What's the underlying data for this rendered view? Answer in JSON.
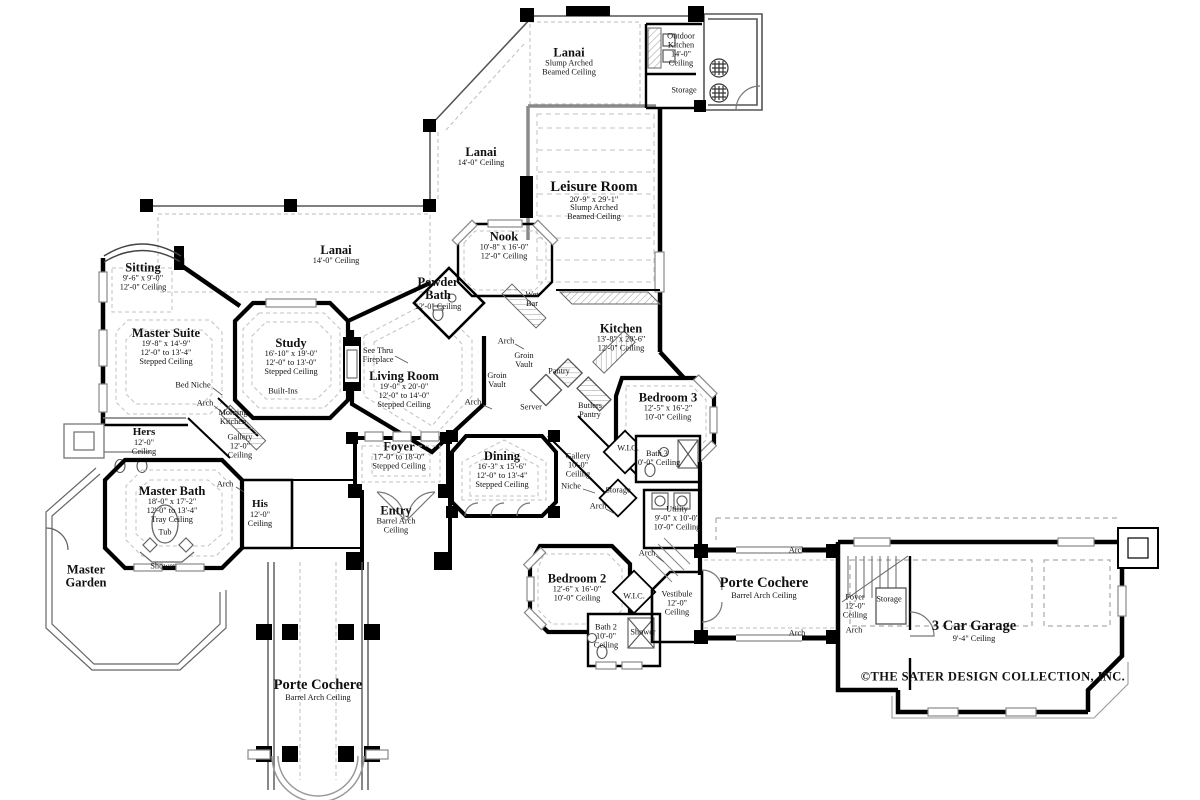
{
  "document": {
    "type": "residential floor plan",
    "copyright": "©THE SATER DESIGN COLLECTION, INC."
  },
  "labels": [
    {
      "id": "lanai-top",
      "x": 569,
      "y": 62,
      "sz": "m",
      "tl": [
        "Lanai"
      ],
      "s": [
        "Slump Arched",
        "Beamed Ceiling"
      ]
    },
    {
      "id": "outdoor-kitchen",
      "x": 681,
      "y": 50,
      "s": [
        "Outdoor",
        "Kitchen",
        "14'-0\"",
        "Ceiling"
      ]
    },
    {
      "id": "storage-outdoor",
      "x": 684,
      "y": 91,
      "s": [
        "Storage"
      ]
    },
    {
      "id": "lanai-upper",
      "x": 481,
      "y": 157,
      "sz": "m",
      "tl": [
        "Lanai"
      ],
      "s": [
        "14'-0\" Ceiling"
      ]
    },
    {
      "id": "leisure-room",
      "x": 594,
      "y": 201,
      "sz": "l",
      "tl": [
        "Leisure Room"
      ],
      "s": [
        "20'-9\" x 29'-1\"",
        "Slump Arched",
        "Beamed Ceiling"
      ]
    },
    {
      "id": "nook",
      "x": 504,
      "y": 246,
      "sz": "m",
      "tl": [
        "Nook"
      ],
      "s": [
        "10'-8\" x 16'-0\"",
        "12'-0\" Ceiling"
      ]
    },
    {
      "id": "lanai-main",
      "x": 336,
      "y": 255,
      "sz": "m",
      "tl": [
        "Lanai"
      ],
      "s": [
        "14'-0\" Ceiling"
      ]
    },
    {
      "id": "sitting",
      "x": 143,
      "y": 277,
      "sz": "m",
      "tl": [
        "Sitting"
      ],
      "s": [
        "9'-6\" x 9'-0\"",
        "12'-0\" Ceiling"
      ]
    },
    {
      "id": "powder-bath",
      "x": 438,
      "y": 294,
      "sz": "m",
      "tl": [
        "Powder",
        "Bath"
      ],
      "s": [
        "12'-0\" Ceiling"
      ]
    },
    {
      "id": "wet-bar",
      "x": 532,
      "y": 300,
      "s": [
        "Wet",
        "Bar"
      ]
    },
    {
      "id": "master-suite",
      "x": 166,
      "y": 347,
      "sz": "m",
      "tl": [
        "Master Suite"
      ],
      "s": [
        "19'-8\" x 14'-9\"",
        "12'-0\" to 13'-4\"",
        "Stepped Ceiling"
      ]
    },
    {
      "id": "study",
      "x": 291,
      "y": 357,
      "sz": "m",
      "tl": [
        "Study"
      ],
      "s": [
        "16'-10\" x 19'-0\"",
        "12'-0\" to 13'-0\"",
        "Stepped Ceiling"
      ]
    },
    {
      "id": "kitchen",
      "x": 621,
      "y": 338,
      "sz": "m",
      "tl": [
        "Kitchen"
      ],
      "s": [
        "13'-8\" x 20'-6\"",
        "12'-0\" Ceiling"
      ]
    },
    {
      "id": "see-thru-fireplace",
      "x": 378,
      "y": 356,
      "s": [
        "See Thru",
        "Fireplace"
      ]
    },
    {
      "id": "arch-wetbar",
      "x": 506,
      "y": 342,
      "s": [
        "Arch"
      ]
    },
    {
      "id": "groin-vault-upper",
      "x": 524,
      "y": 361,
      "s": [
        "Groin",
        "Vault"
      ]
    },
    {
      "id": "pantry",
      "x": 559,
      "y": 372,
      "s": [
        "Pantry"
      ]
    },
    {
      "id": "living-room",
      "x": 404,
      "y": 390,
      "sz": "m",
      "tl": [
        "Living Room"
      ],
      "s": [
        "19'-0\" x 20'-0\"",
        "12'-0\" to 14'-0\"",
        "Stepped Ceiling"
      ]
    },
    {
      "id": "groin-vault-lower",
      "x": 497,
      "y": 381,
      "s": [
        "Groin",
        "Vault"
      ]
    },
    {
      "id": "arch-living",
      "x": 473,
      "y": 403,
      "s": [
        "Arch"
      ]
    },
    {
      "id": "server",
      "x": 531,
      "y": 408,
      "s": [
        "Server"
      ]
    },
    {
      "id": "butlers-pantry",
      "x": 590,
      "y": 411,
      "s": [
        "Butlers",
        "Pantry"
      ]
    },
    {
      "id": "bedroom-3",
      "x": 668,
      "y": 407,
      "sz": "m",
      "tl": [
        "Bedroom 3"
      ],
      "s": [
        "12'-5\" x 16'-2\"",
        "10'-0\" Ceiling"
      ]
    },
    {
      "id": "bed-niche",
      "x": 193,
      "y": 386,
      "s": [
        "Bed Niche"
      ]
    },
    {
      "id": "arch-master",
      "x": 205,
      "y": 404,
      "s": [
        "Arch"
      ]
    },
    {
      "id": "morning-kitchen",
      "x": 233,
      "y": 418,
      "s": [
        "Morning",
        "Kitchen"
      ]
    },
    {
      "id": "built-ins",
      "x": 283,
      "y": 392,
      "s": [
        "Built-Ins"
      ]
    },
    {
      "id": "hers",
      "x": 144,
      "y": 442,
      "sz": "s",
      "tl": [
        "Hers"
      ],
      "s": [
        "12'-0\"",
        "Ceiling"
      ]
    },
    {
      "id": "gallery-master",
      "x": 240,
      "y": 447,
      "s": [
        "Gallery",
        "12'-0\"",
        "Ceiling"
      ]
    },
    {
      "id": "wic-1",
      "x": 628,
      "y": 449,
      "s": [
        "W.I.C."
      ]
    },
    {
      "id": "bath-3",
      "x": 657,
      "y": 459,
      "s": [
        "Bath 3",
        "10'-0\" Ceiling"
      ]
    },
    {
      "id": "foyer",
      "x": 399,
      "y": 456,
      "sz": "m",
      "tl": [
        "Foyer"
      ],
      "s": [
        "17'-0\" to 18'-0\"",
        "Stepped Ceiling"
      ]
    },
    {
      "id": "dining",
      "x": 502,
      "y": 470,
      "sz": "m",
      "tl": [
        "Dining"
      ],
      "s": [
        "16'-3\" x 15'-6\"",
        "12'-0\" to 13'-4\"",
        "Stepped Ceiling"
      ]
    },
    {
      "id": "gallery-main",
      "x": 578,
      "y": 466,
      "s": [
        "Gallery",
        "10'-0\"",
        "Ceiling"
      ]
    },
    {
      "id": "niche",
      "x": 571,
      "y": 487,
      "s": [
        "Niche"
      ]
    },
    {
      "id": "storage-hall",
      "x": 618,
      "y": 491,
      "s": [
        "Storage"
      ]
    },
    {
      "id": "master-bath",
      "x": 172,
      "y": 505,
      "sz": "m",
      "tl": [
        "Master Bath"
      ],
      "s": [
        "18'-0\" x 17'-2\"",
        "12'-0\" to 13'-4\"",
        "Tray Ceiling"
      ]
    },
    {
      "id": "arch-his",
      "x": 225,
      "y": 485,
      "s": [
        "Arch"
      ]
    },
    {
      "id": "his",
      "x": 260,
      "y": 514,
      "sz": "s",
      "tl": [
        "His"
      ],
      "s": [
        "12'-0\"",
        "Ceiling"
      ]
    },
    {
      "id": "utility",
      "x": 677,
      "y": 519,
      "s": [
        "Utility",
        "9'-0\" x 10'-0\"",
        "10'-0\" Ceiling"
      ]
    },
    {
      "id": "arch-gallery",
      "x": 598,
      "y": 507,
      "s": [
        "Arch"
      ]
    },
    {
      "id": "entry",
      "x": 396,
      "y": 520,
      "sz": "m",
      "tl": [
        "Entry"
      ],
      "s": [
        "Barrel Arch",
        "Ceiling"
      ]
    },
    {
      "id": "tub",
      "x": 165,
      "y": 533,
      "s": [
        "Tub"
      ]
    },
    {
      "id": "master-garden",
      "x": 86,
      "y": 577,
      "sz": "m",
      "tl": [
        "Master",
        "Garden"
      ]
    },
    {
      "id": "shower-master",
      "x": 163,
      "y": 567,
      "s": [
        "Shower"
      ]
    },
    {
      "id": "bedroom-2",
      "x": 577,
      "y": 588,
      "sz": "m",
      "tl": [
        "Bedroom 2"
      ],
      "s": [
        "12'-6\" x 16'-0\"",
        "10'-0\" Ceiling"
      ]
    },
    {
      "id": "arch-vestibule",
      "x": 647,
      "y": 554,
      "s": [
        "Arch"
      ]
    },
    {
      "id": "wic-2",
      "x": 634,
      "y": 597,
      "s": [
        "W.I.C."
      ]
    },
    {
      "id": "vestibule",
      "x": 677,
      "y": 604,
      "s": [
        "Vestibule",
        "12'-0\"",
        "Ceiling"
      ]
    },
    {
      "id": "porte-cochere-east",
      "x": 764,
      "y": 588,
      "sz": "l",
      "tl": [
        "Porte Cochere"
      ],
      "s": [
        "Barrel Arch Ceiling"
      ]
    },
    {
      "id": "arch-pc-east-top",
      "x": 797,
      "y": 551,
      "s": [
        "Arch"
      ]
    },
    {
      "id": "arch-pc-east-bottom",
      "x": 797,
      "y": 634,
      "s": [
        "Arch"
      ]
    },
    {
      "id": "bath-2",
      "x": 606,
      "y": 637,
      "s": [
        "Bath 2",
        "10'-0\"",
        "Ceiling"
      ]
    },
    {
      "id": "shower-2",
      "x": 643,
      "y": 633,
      "s": [
        "Shower"
      ]
    },
    {
      "id": "foyer-garage",
      "x": 855,
      "y": 607,
      "s": [
        "Foyer",
        "12'-0\"",
        "Ceiling"
      ]
    },
    {
      "id": "storage-garage",
      "x": 889,
      "y": 600,
      "s": [
        "Storage"
      ]
    },
    {
      "id": "arch-garage",
      "x": 854,
      "y": 631,
      "s": [
        "Arch"
      ]
    },
    {
      "id": "garage",
      "x": 974,
      "y": 631,
      "sz": "l",
      "tl": [
        "3 Car Garage"
      ],
      "s": [
        "9'-4\" Ceiling"
      ]
    },
    {
      "id": "porte-cochere-south",
      "x": 318,
      "y": 690,
      "sz": "l",
      "tl": [
        "Porte Cochere"
      ],
      "s": [
        "Barrel Arch Ceiling"
      ]
    }
  ]
}
